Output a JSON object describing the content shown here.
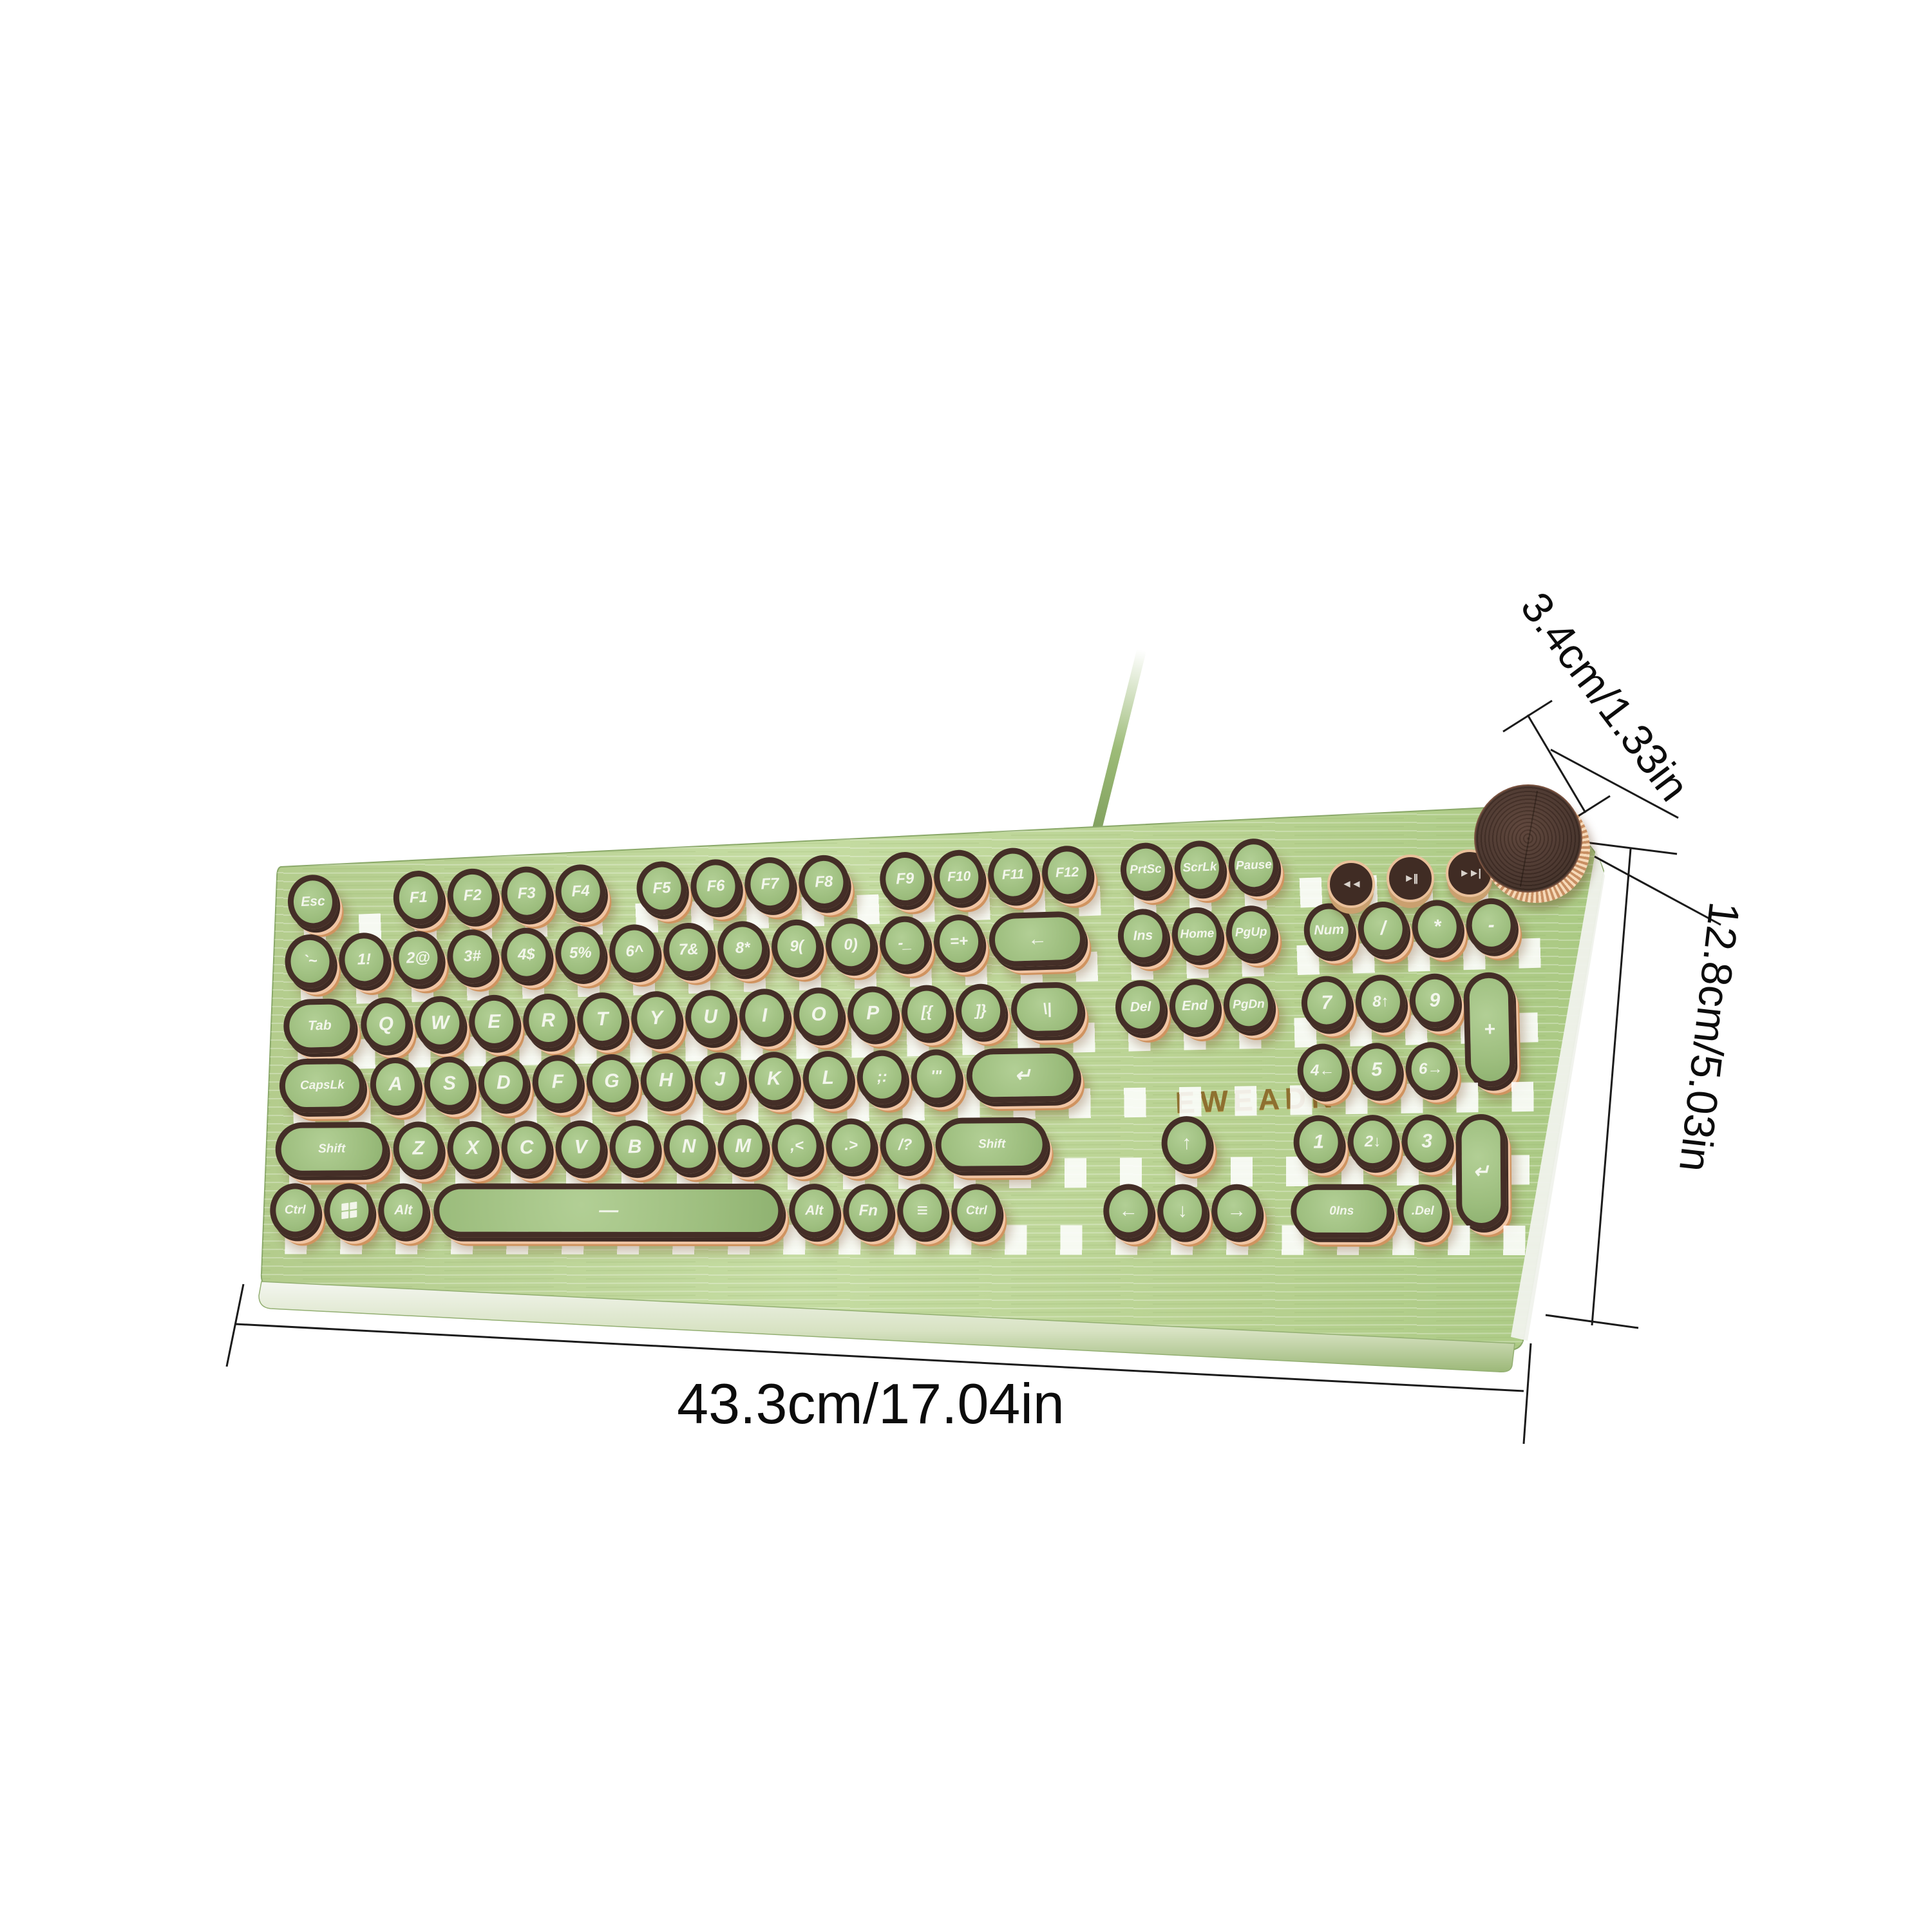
{
  "brand": "EWEADN",
  "dimensions": {
    "knob_height": "3.4cm/1.33in",
    "keyboard_depth": "12.8cm/5.03in",
    "keyboard_width": "43.3cm/17.04in"
  },
  "colors": {
    "board_green": "#b9d292",
    "keycap_green": "#a3c284",
    "keycap_ring_brown": "#442e27",
    "copper": "#e8b68d",
    "knob_brown": "#47322a",
    "logo_gold": "#8e7030",
    "dimension_line": "#1b1b1b"
  },
  "media_keys": {
    "previous": "◄◄",
    "play_pause": "►||",
    "next": "►►|"
  },
  "keyboard": {
    "rows": [
      [
        {
          "l": "Esc"
        },
        {
          "g": 0.95
        },
        {
          "l": "F1"
        },
        {
          "l": "F2"
        },
        {
          "l": "F3"
        },
        {
          "l": "F4"
        },
        {
          "g": 0.5
        },
        {
          "l": "F5"
        },
        {
          "l": "F6"
        },
        {
          "l": "F7"
        },
        {
          "l": "F8"
        },
        {
          "g": 0.5
        },
        {
          "l": "F9"
        },
        {
          "l": "F10"
        },
        {
          "l": "F11"
        },
        {
          "l": "F12"
        },
        {
          "g": 0.45
        },
        {
          "l": "PrtSc"
        },
        {
          "l": "ScrLk"
        },
        {
          "l": "Pause"
        }
      ],
      [
        {
          "l": "`~"
        },
        {
          "l": "1!"
        },
        {
          "l": "2@"
        },
        {
          "l": "3#"
        },
        {
          "l": "4$"
        },
        {
          "l": "5%"
        },
        {
          "l": "6^"
        },
        {
          "l": "7&"
        },
        {
          "l": "8*"
        },
        {
          "l": "9("
        },
        {
          "l": "0)"
        },
        {
          "l": "-_"
        },
        {
          "l": "=+"
        },
        {
          "l": "←",
          "n": "backspace",
          "c": "pill",
          "w": 1.9
        },
        {
          "g": 0.5
        },
        {
          "l": "Ins"
        },
        {
          "l": "Home"
        },
        {
          "l": "PgUp"
        },
        {
          "g": 0.45
        },
        {
          "l": "Num"
        },
        {
          "l": "/",
          "n": "numpad-divide"
        },
        {
          "l": "*",
          "n": "numpad-multiply"
        },
        {
          "l": "-",
          "n": "numpad-minus"
        }
      ],
      [
        {
          "l": "Tab",
          "c": "pill",
          "w": 1.45
        },
        {
          "l": "Q"
        },
        {
          "l": "W"
        },
        {
          "l": "E"
        },
        {
          "l": "R"
        },
        {
          "l": "T"
        },
        {
          "l": "Y"
        },
        {
          "l": "U"
        },
        {
          "l": "I"
        },
        {
          "l": "O"
        },
        {
          "l": "P"
        },
        {
          "l": "[{"
        },
        {
          "l": "]}"
        },
        {
          "l": "\\|",
          "c": "pill",
          "w": 1.45
        },
        {
          "g": 0.5
        },
        {
          "l": "Del"
        },
        {
          "l": "End"
        },
        {
          "l": "PgDn"
        },
        {
          "g": 0.45
        },
        {
          "l": "7",
          "n": "numpad-7"
        },
        {
          "l": "8↑",
          "n": "numpad-8"
        },
        {
          "l": "9",
          "n": "numpad-9"
        },
        {
          "l": "+",
          "n": "numpad-plus",
          "c": "vpill"
        }
      ],
      [
        {
          "l": "CapsLk",
          "c": "pill",
          "w": 1.7
        },
        {
          "l": "A"
        },
        {
          "l": "S"
        },
        {
          "l": "D"
        },
        {
          "l": "F"
        },
        {
          "l": "G"
        },
        {
          "l": "H"
        },
        {
          "l": "J"
        },
        {
          "l": "K"
        },
        {
          "l": "L"
        },
        {
          "l": ";:"
        },
        {
          "l": "'\""
        },
        {
          "l": "↵",
          "n": "enter",
          "c": "pill",
          "w": 2.2
        },
        {
          "g": 0.5
        },
        {
          "l": "",
          "n": "spacer",
          "c": "sp",
          "w": 3
        },
        {
          "g": 0.45
        },
        {
          "l": "4←",
          "n": "numpad-4"
        },
        {
          "l": "5",
          "n": "numpad-5"
        },
        {
          "l": "6→",
          "n": "numpad-6"
        }
      ],
      [
        {
          "l": "Shift",
          "n": "left-shift",
          "c": "pill",
          "w": 2.2
        },
        {
          "l": "Z"
        },
        {
          "l": "X"
        },
        {
          "l": "C"
        },
        {
          "l": "V"
        },
        {
          "l": "B"
        },
        {
          "l": "N"
        },
        {
          "l": "M"
        },
        {
          "l": ",<"
        },
        {
          "l": ".>"
        },
        {
          "l": "/?"
        },
        {
          "l": "Shift",
          "n": "right-shift",
          "c": "pill",
          "w": 2.2
        },
        {
          "g": 1.0
        },
        {
          "l": "",
          "n": "spacer",
          "c": "sp"
        },
        {
          "l": "↑",
          "n": "arrow-up"
        },
        {
          "l": "",
          "n": "spacer",
          "c": "sp"
        },
        {
          "g": 0.45
        },
        {
          "l": "1",
          "n": "numpad-1"
        },
        {
          "l": "2↓",
          "n": "numpad-2"
        },
        {
          "l": "3",
          "n": "numpad-3"
        },
        {
          "l": "↵",
          "n": "numpad-enter",
          "c": "vpill"
        }
      ],
      [
        {
          "l": "Ctrl",
          "n": "left-ctrl"
        },
        {
          "l": "",
          "n": "win",
          "icon": "windows-logo"
        },
        {
          "l": "Alt",
          "n": "left-alt"
        },
        {
          "l": "—",
          "n": "space",
          "c": "pill",
          "w": 6.6
        },
        {
          "l": "Alt",
          "n": "right-alt"
        },
        {
          "l": "Fn"
        },
        {
          "l": "≡",
          "n": "menu"
        },
        {
          "l": "Ctrl",
          "n": "right-ctrl"
        },
        {
          "g": 1.8
        },
        {
          "l": "←",
          "n": "arrow-left"
        },
        {
          "l": "↓",
          "n": "arrow-down"
        },
        {
          "l": "→",
          "n": "arrow-right"
        },
        {
          "g": 0.45
        },
        {
          "l": "0Ins",
          "n": "numpad-0-ins",
          "c": "pill",
          "w": 2
        },
        {
          "l": ".Del",
          "n": "numpad-dot-del"
        }
      ]
    ]
  }
}
